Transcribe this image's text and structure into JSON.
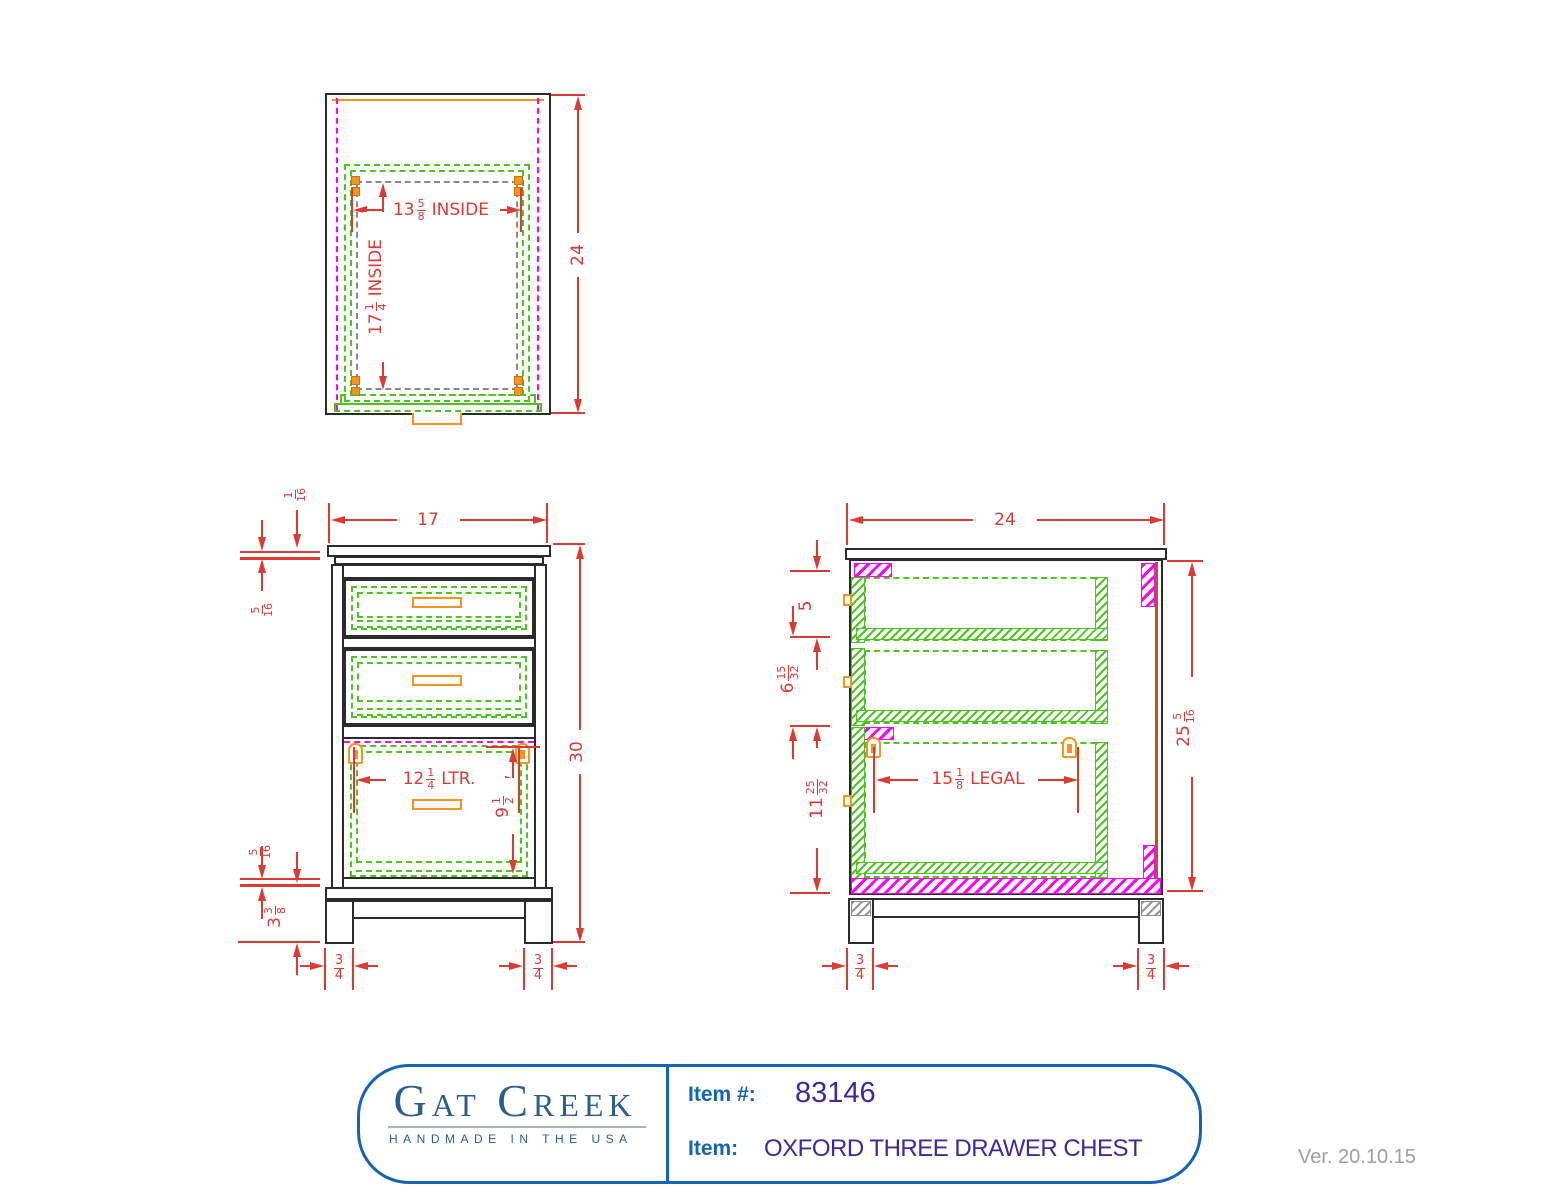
{
  "colors": {
    "dimension_red": "#dd3a32",
    "drawer_green": "#4ec41f",
    "panel_magenta": "#ff00ff",
    "hardware_orange": "#f7941d",
    "outline_black": "#2b2b2b",
    "reference_gray": "#8a8a8a",
    "back_panel_brown": "#b05a1e",
    "brand_blue": "#2b5e8c",
    "label_blue": "#1464b4",
    "value_purple": "#3c28a0",
    "version_gray": "#9f9f9f"
  },
  "dims": {
    "top": {
      "inside_width": {
        "whole": "13",
        "num": "5",
        "den": "8",
        "suffix": "INSIDE"
      },
      "inside_depth": {
        "whole": "17",
        "num": "1",
        "den": "4",
        "suffix": "INSIDE"
      },
      "depth": "24"
    },
    "front": {
      "width": "17",
      "top_overhang": {
        "num": "1",
        "den": "16"
      },
      "top_reveal": {
        "num": "5",
        "den": "16"
      },
      "height": "30",
      "letter_width": {
        "whole": "12",
        "num": "1",
        "den": "4",
        "suffix": "LTR."
      },
      "file_depth": {
        "whole": "9",
        "num": "1",
        "den": "2"
      },
      "bottom_reveal": {
        "num": "5",
        "den": "16"
      },
      "leg_height": {
        "whole": "3",
        "num": "3",
        "den": "8"
      },
      "leg_left": {
        "num": "3",
        "den": "4"
      },
      "leg_right": {
        "num": "3",
        "den": "4"
      }
    },
    "side": {
      "depth": "24",
      "top_drawer": "5",
      "middle_drawer": {
        "whole": "6",
        "num": "15",
        "den": "32"
      },
      "file_drawer": {
        "whole": "11",
        "num": "25",
        "den": "32"
      },
      "legal_width": {
        "whole": "15",
        "num": "1",
        "den": "8",
        "suffix": "LEGAL"
      },
      "case_height": {
        "whole": "25",
        "num": "5",
        "den": "16"
      },
      "leg_left": {
        "num": "3",
        "den": "4"
      },
      "leg_right": {
        "num": "3",
        "den": "4"
      }
    }
  },
  "title_block": {
    "brand": "Gat Creek",
    "tagline": "HANDMADE IN THE USA",
    "item_number_label": "Item #:",
    "item_number": "83146",
    "item_label": "Item:",
    "item_name": "OXFORD THREE DRAWER CHEST"
  },
  "footer": {
    "version": "Ver. 20.10.15"
  }
}
